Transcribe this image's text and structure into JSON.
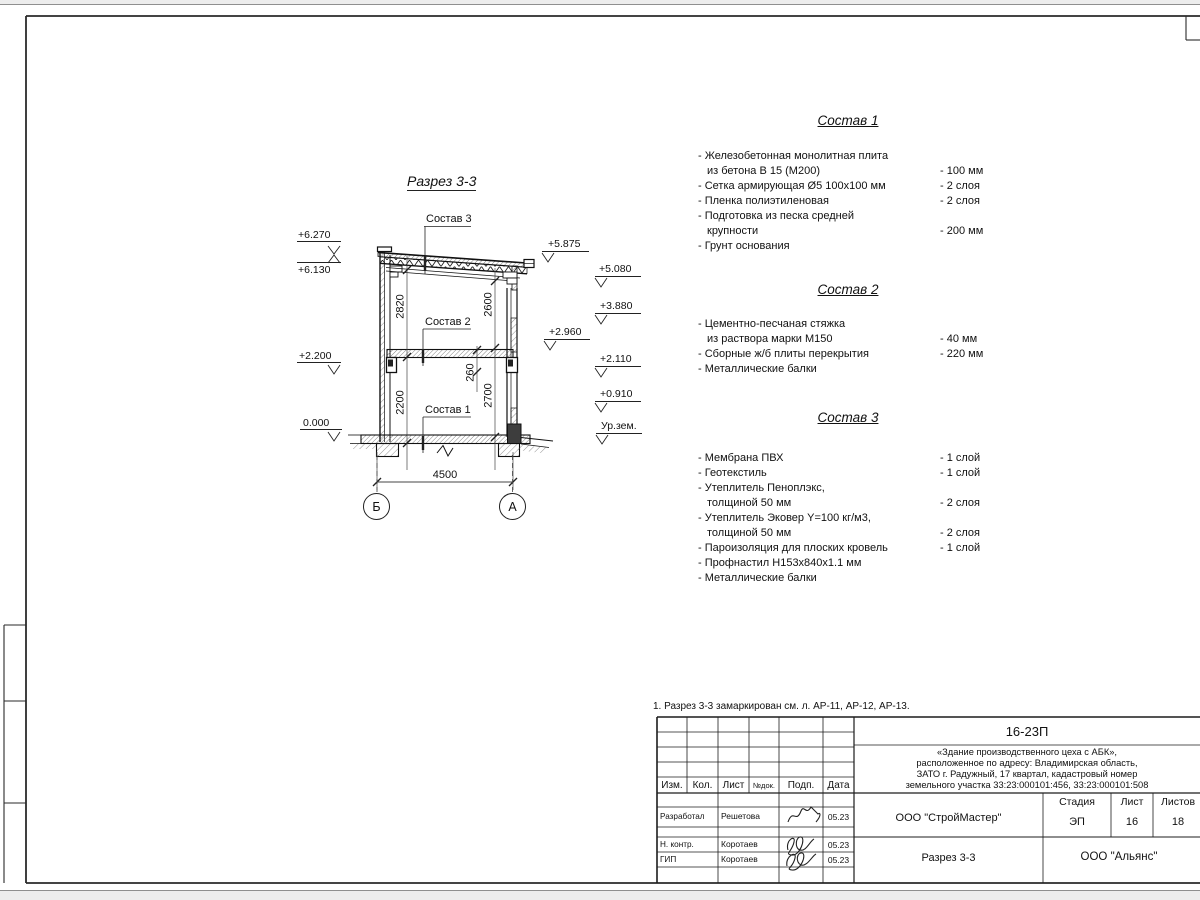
{
  "sheet": {
    "note": "1. Разрез 3-3 замаркирован см. л. АР-11, АР-12, АР-13."
  },
  "drawing": {
    "title": "Разрез 3-3",
    "callouts": {
      "c1": "Состав 1",
      "c2": "Состав 2",
      "c3": "Состав 3"
    },
    "elevations": {
      "e6270": "+6.270",
      "e6130": "+6.130",
      "e2200": "+2.200",
      "e0000": "0.000",
      "e5875": "+5.875",
      "e5080": "+5.080",
      "e3880": "+3.880",
      "e2960": "+2.960",
      "e2110": "+2.110",
      "e0910": "+0.910",
      "ground": "Ур.зем."
    },
    "dims": {
      "h1": "2820",
      "h2": "2600",
      "h3": "2200",
      "h4": "2700",
      "h5": "260",
      "w1": "4500"
    },
    "axes": {
      "left": "Б",
      "right": "А"
    }
  },
  "compositions": [
    {
      "title": "Состав 1",
      "items": [
        {
          "lines": [
            "- Железобетонная  монолитная плита",
            "из бетона В 15 (М200)"
          ],
          "value": "- 100 мм"
        },
        {
          "lines": [
            "- Сетка армирующая Ø5 100x100 мм"
          ],
          "value": "- 2 слоя"
        },
        {
          "lines": [
            "- Пленка полиэтиленовая"
          ],
          "value": "-  2 слоя"
        },
        {
          "lines": [
            "- Подготовка из песка средней",
            "крупности"
          ],
          "value": "- 200 мм"
        },
        {
          "lines": [
            "- Грунт основания"
          ],
          "value": ""
        }
      ]
    },
    {
      "title": "Состав 2",
      "items": [
        {
          "lines": [
            "- Цементно-песчаная стяжка",
            "из раствора марки М150"
          ],
          "value": "- 40 мм"
        },
        {
          "lines": [
            "- Сборные ж/б плиты перекрытия"
          ],
          "value": "- 220 мм"
        },
        {
          "lines": [
            "- Металлические балки"
          ],
          "value": ""
        }
      ]
    },
    {
      "title": "Состав 3",
      "items": [
        {
          "lines": [
            "- Мембрана ПВХ"
          ],
          "value": "- 1 слой"
        },
        {
          "lines": [
            "- Геотекстиль"
          ],
          "value": "- 1 слой"
        },
        {
          "lines": [
            "- Утеплитель Пеноплэкс,",
            "толщиной 50 мм"
          ],
          "value": "- 2 слоя"
        },
        {
          "lines": [
            "- Утеплитель Эковер Y=100 кг/м3,",
            "толщиной 50 мм"
          ],
          "value": "- 2 слоя"
        },
        {
          "lines": [
            "- Пароизоляция для плоских кровель"
          ],
          "value": "- 1 слой"
        },
        {
          "lines": [
            "- Профнастил Н153х840х1.1 мм"
          ],
          "value": ""
        },
        {
          "lines": [
            "- Металлические балки"
          ],
          "value": ""
        }
      ]
    }
  ],
  "titleblock": {
    "doc_code": "16-23П",
    "address_lines": [
      "«Здание производственного цеха с АБК»,",
      "расположенное по адресу: Владимирская область,",
      "ЗАТО г. Радужный, 17 квартал, кадастровый номер",
      "земельного участка 33:23:000101:456, 33:23:000101:508"
    ],
    "header_cols": {
      "izm": "Изм.",
      "kol": "Кол.",
      "list": "Лист",
      "ndok": "№док.",
      "podp": "Подп.",
      "data": "Дата"
    },
    "stage_cols": {
      "stage": "Стадия",
      "sheet": "Лист",
      "sheets": "Листов"
    },
    "stage_vals": {
      "stage": "ЭП",
      "sheet": "16",
      "sheets": "18"
    },
    "org": "ООО \"СтройМастер\"",
    "section_name": "Разрез 3-3",
    "customer": "ООО \"Альянс\"",
    "sign_rows": [
      {
        "role": "Разработал",
        "name": "Решетова",
        "date": "05.23"
      },
      {
        "role": "Н. контр.",
        "name": "Коротаев",
        "date": "05.23"
      },
      {
        "role": "ГИП",
        "name": "Коротаев",
        "date": "05.23"
      }
    ]
  }
}
